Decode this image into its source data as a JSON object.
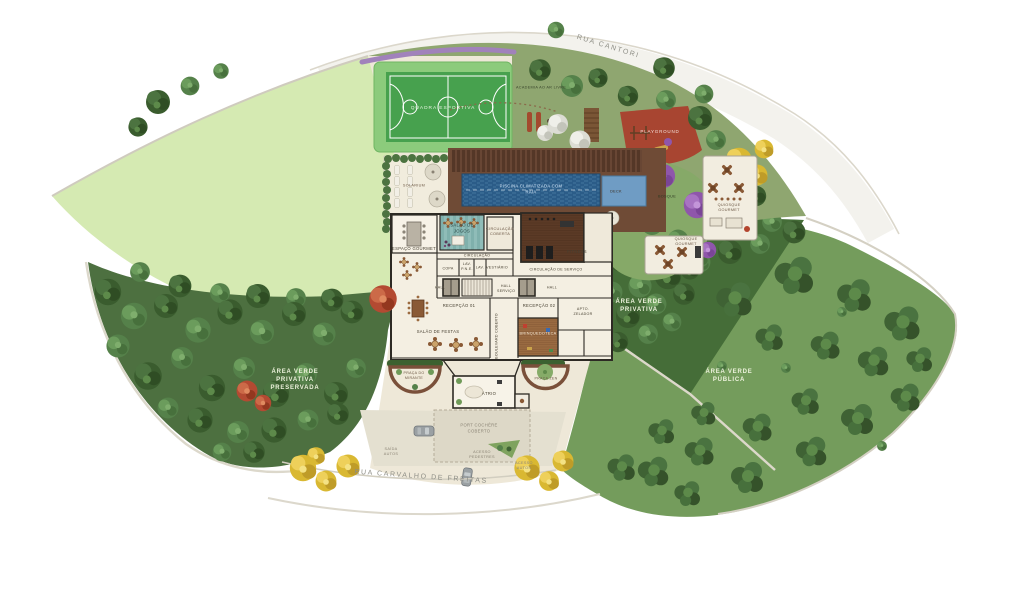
{
  "plan": {
    "streets": {
      "top": "RUA CANTORI",
      "bottom": "RUA CARVALHO DE FREITAS"
    },
    "green_areas": {
      "left_preserved": "ÁREA VERDE PRIVATIVA PRESERVADA",
      "right_private": "ÁREA VERDE PRIVATIVA",
      "right_public": "ÁREA VERDE PÚBLICA"
    },
    "leisure": {
      "sports_court": "QUADRA ESPORTIVA",
      "outdoor_gym": "ACADEMIA AO AR LIVRE",
      "playground": "PLAYGROUND",
      "grove": "BOSQUE",
      "deck": "DECK",
      "gourmet_kiosk_upper": "QUIOSQUE GOURMET",
      "gourmet_kiosk_lower": "QUIOSQUE GOURMET",
      "solarium": "SOLARIUM",
      "pool": "PISCINA CLIMATIZADA COM RAIA",
      "lookout_square": "PRAÇA DO MIRANTE",
      "zen_square": "PRAÇA ZEN"
    },
    "building": {
      "gourmet_room": "ESPAÇO GOURMET",
      "games_room": "SALÃO DE JOGOS",
      "covered_circulation": "CIRCULAÇÃO COBERTA",
      "fitness": "FITNESS",
      "circulation": "CIRCULAÇÃO",
      "pantry": "COPA",
      "lav_pne": "LAV. P.N.E.",
      "lav": "LAV.",
      "locker_room": "VESTIÁRIO",
      "service_circulation": "CIRCULAÇÃO DE SERVIÇO",
      "hall_left": "HALL",
      "service_hall": "HALL SERVIÇO",
      "hall_right": "HALL",
      "reception_1": "RECEPÇÃO 01",
      "reception_2": "RECEPÇÃO 02",
      "caretaker_apt": "APTO. ZELADOR",
      "party_room": "SALÃO DE FESTAS",
      "playroom": "BRINQUEDOTECA",
      "covered_boulevard": "BOULEVARD COBERTO",
      "atrium": "ÁTRIO",
      "port_cochere": "PORT COCHÈRE COBERTO"
    },
    "access": {
      "car_exit": "SAÍDA AUTOS",
      "pedestrian_entry": "ACESSO PEDESTRES",
      "car_entry": "ACESSO AUTOS"
    }
  },
  "colors": {
    "lawn_light": "#d5eab2",
    "forest": "#4d7040",
    "public_green": "#749c5c",
    "private_green": "#456d38",
    "garden_olive": "#8fa670",
    "parcel": "#eee8d8",
    "court_green": "#47a14e",
    "pool_water": "#2b5c88",
    "playground_red": "#a84531",
    "deck_wood": "#6f4b36",
    "wall": "#2d2a24"
  }
}
